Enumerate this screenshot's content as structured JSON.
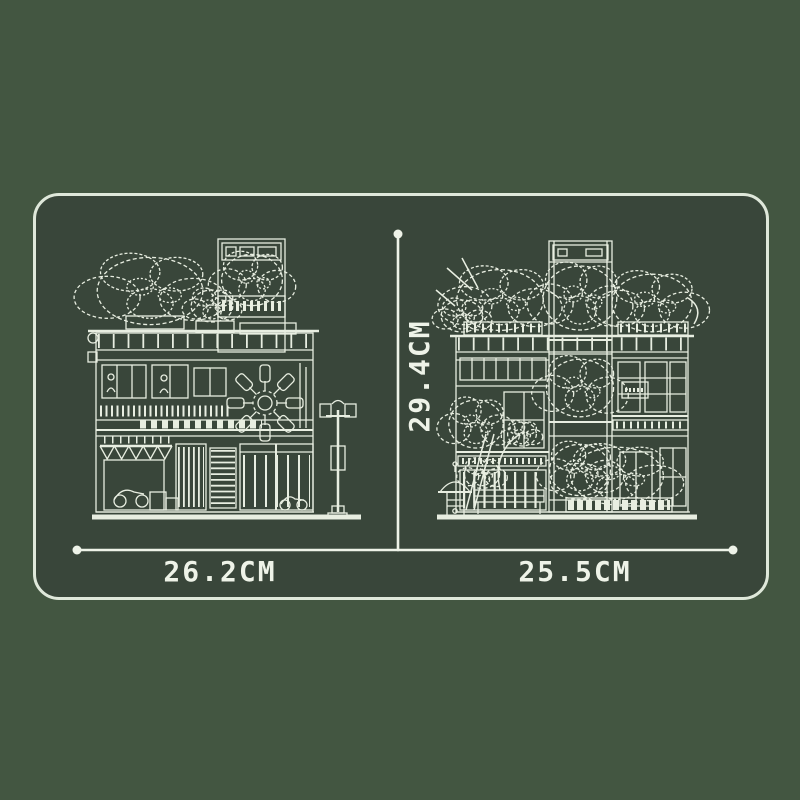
{
  "colors": {
    "background": "#435641",
    "panel": "#39463a",
    "panel_border": "#dfe8da",
    "line_art": "#e8eee1",
    "label_text": "#eef3e8"
  },
  "dimensions": {
    "left_width": "26.2CM",
    "right_width": "25.5CM",
    "height": "29.4CM"
  }
}
